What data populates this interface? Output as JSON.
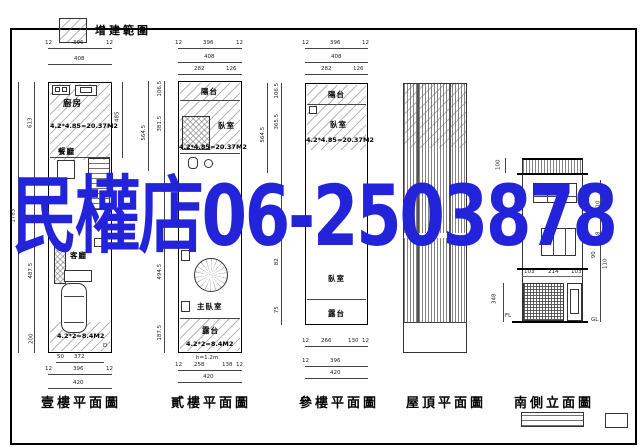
{
  "legend": {
    "label": "增建範圍"
  },
  "overlay": {
    "text": "民權店06-2503878",
    "color": "#2323d9"
  },
  "plan1": {
    "title": "壹樓平面圖",
    "kitchen": "廚房",
    "dining": "餐廳",
    "living": "客廳",
    "kitchen_area": "4.2*4.85=20.37M2",
    "garage_area": "4.2*2=8.4M2",
    "door": "D",
    "d_top_l": "12",
    "d_top_c": "396",
    "d_top_r": "12",
    "d_top2": "408",
    "d_left_total": "1783",
    "d_left1": "613",
    "d_left2": "487.5",
    "d_left3": "200",
    "d_right1": "485",
    "d_bot_a1": "50",
    "d_bot_a2": "372",
    "d_bot_l": "12",
    "d_bot_c": "396",
    "d_bot_r": "12",
    "d_bot2": "420"
  },
  "plan2": {
    "title": "貳樓平面圖",
    "balcony": "陽台",
    "bedroom": "臥室",
    "master": "主臥室",
    "terrace": "露台",
    "bedroom_area": "4.2*4.85=20.37M2",
    "terrace_area": "4.2*2=8.4M2",
    "note": "h=1.2m",
    "d_top_l": "12",
    "d_top_c": "396",
    "d_top_r": "12",
    "d_top2": "408",
    "d_top3a": "282",
    "d_top3b": "126",
    "d_left_out": "564.5",
    "d_left1": "106.5",
    "d_left2": "381.5",
    "d_left3": "494.5",
    "d_left4": "187.5",
    "d_bot_l": "12",
    "d_bot_a": "258",
    "d_bot_b": "138",
    "d_bot_r": "12",
    "d_bot2": "420"
  },
  "plan3": {
    "title": "參樓平面圖",
    "balcony": "陽台",
    "bedroom_up": "臥室",
    "bedroom_low": "臥室",
    "terrace": "露台",
    "bedroom_area": "4.2*4.85=20.37M2",
    "d_top_l": "12",
    "d_top_c": "396",
    "d_top_r": "12",
    "d_top2": "408",
    "d_top3a": "282",
    "d_top3b": "126",
    "d_left_out": "564.5",
    "d_left1": "106.5",
    "d_left2": "365.5",
    "d_left3": "82",
    "d_left4": "75",
    "d_bot_l": "12",
    "d_bot_a": "266",
    "d_bot_b": "130",
    "d_bot_r": "12",
    "d_bot_l2": "12",
    "d_bot_c": "396",
    "d_bot2": "420"
  },
  "plan4": {
    "title": "屋頂平面圖"
  },
  "elev": {
    "title": "南側立面圖",
    "fl3": "3FL",
    "fl": "FL",
    "gl": "GL",
    "d_rail": "100",
    "d_left": "348",
    "d_r1": "110",
    "d_r2": "318",
    "d_r3": "90",
    "d_r4": "110",
    "d_b1": "103",
    "d_b2": "214",
    "d_b3": "103"
  }
}
